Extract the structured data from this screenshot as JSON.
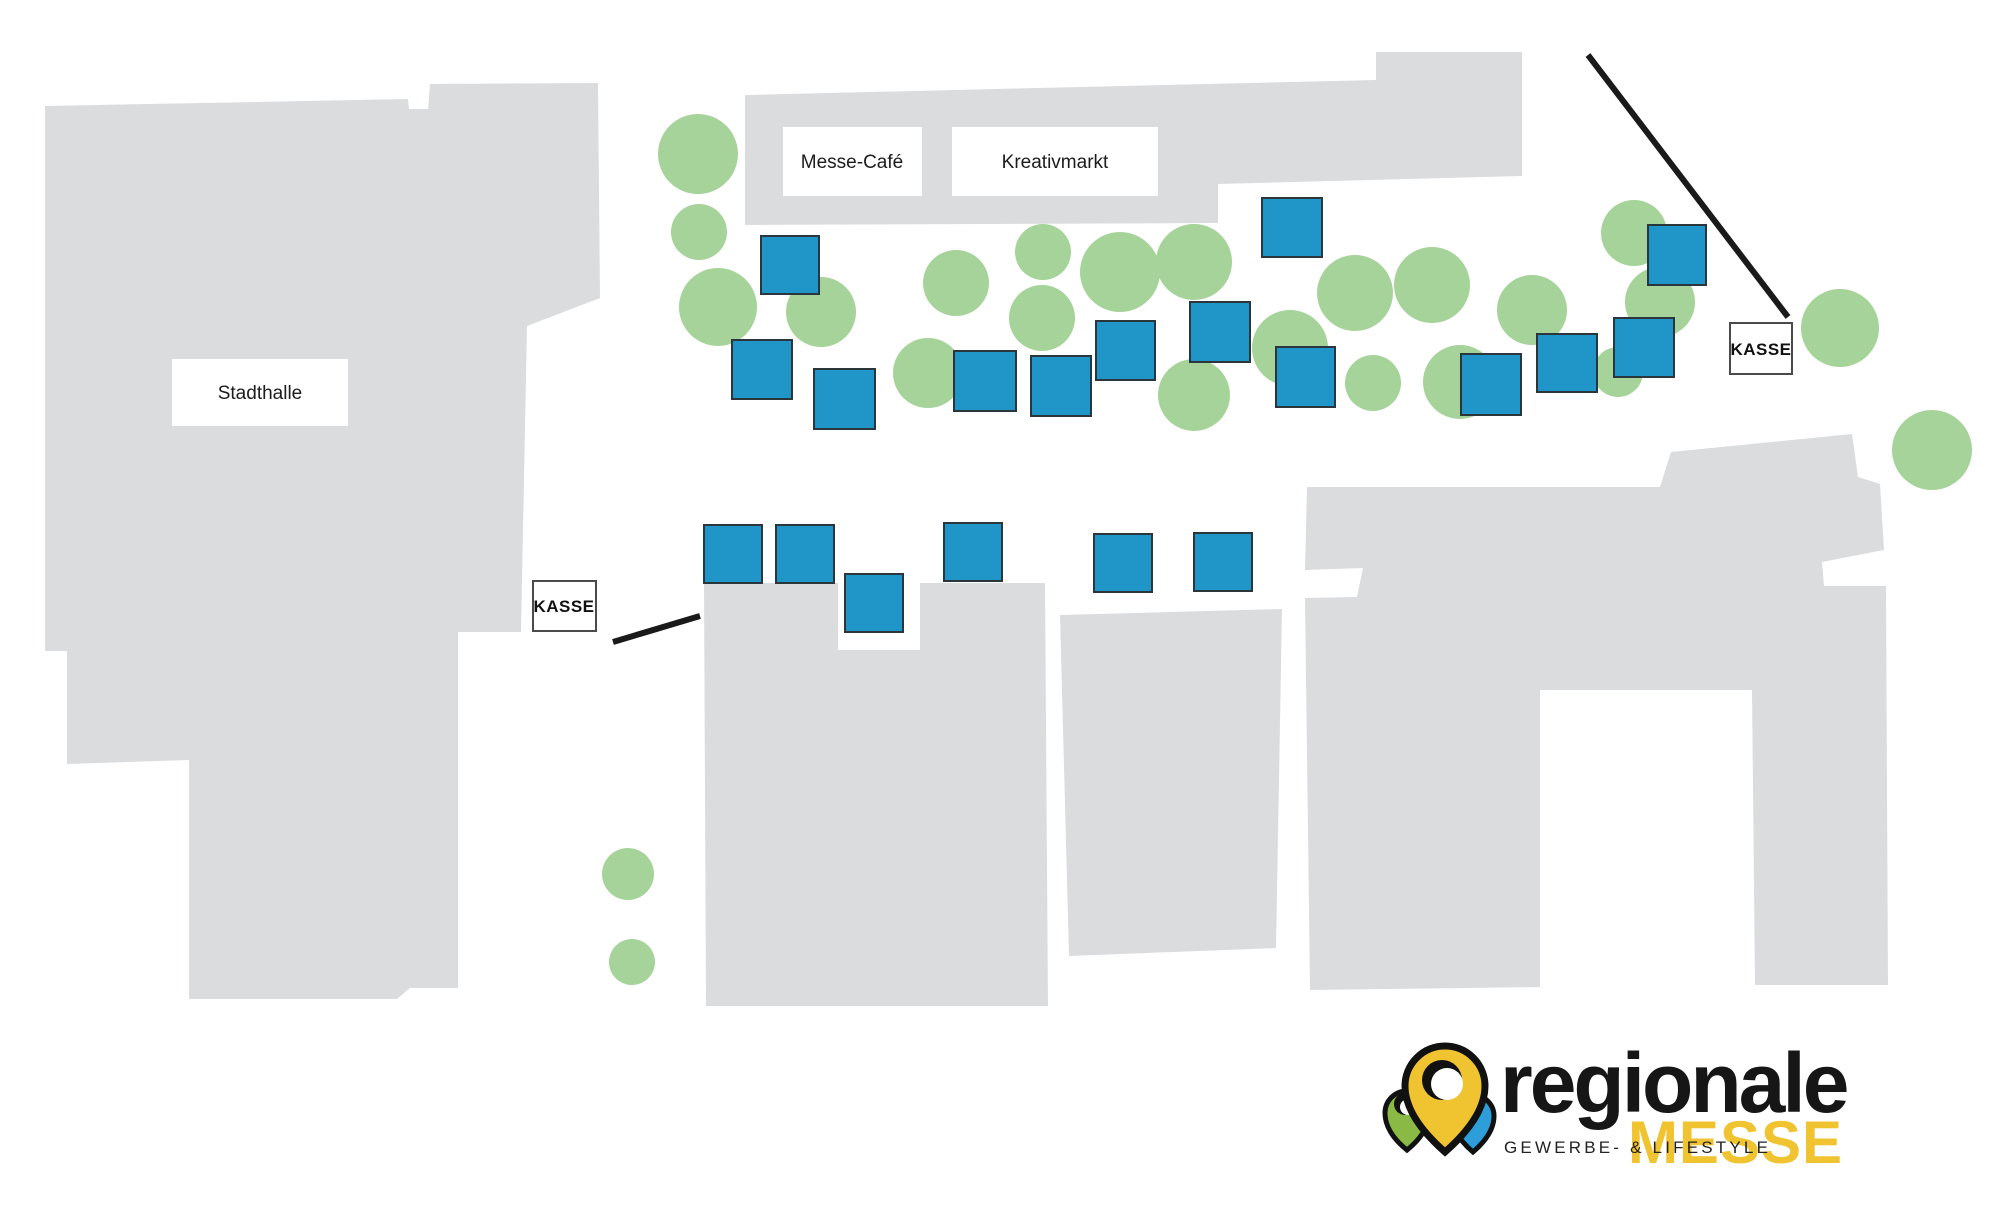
{
  "labels": {
    "stadthalle": {
      "text": "Stadthalle"
    },
    "messe_cafe": {
      "text": "Messe-Café"
    },
    "kreativmarkt": {
      "text": "Kreativmarkt"
    },
    "kasse_left": {
      "text": "KASSE"
    },
    "kasse_right": {
      "text": "KASSE"
    }
  },
  "logo": {
    "brand": "regionale",
    "brand_sub": "MESSE",
    "tagline": "GEWERBE- & LIFESTYLE"
  },
  "colors": {
    "booth": "#2095c8",
    "booth_border": "#2a353c",
    "tree": "#a6d399",
    "building": "#dbdcde",
    "line": "#1a1a1a",
    "logo_yellow": "#f0c330",
    "logo_green": "#8aba45",
    "logo_blue": "#2d9ed9"
  },
  "map": {
    "booths": [
      [
        761,
        236,
        58,
        58
      ],
      [
        732,
        340,
        60,
        59
      ],
      [
        814,
        369,
        61,
        60
      ],
      [
        954,
        351,
        62,
        60
      ],
      [
        1031,
        356,
        60,
        60
      ],
      [
        1096,
        321,
        59,
        59
      ],
      [
        1190,
        302,
        60,
        60
      ],
      [
        1262,
        198,
        60,
        59
      ],
      [
        1276,
        347,
        59,
        60
      ],
      [
        1461,
        354,
        60,
        61
      ],
      [
        1537,
        334,
        60,
        58
      ],
      [
        1614,
        318,
        60,
        59
      ],
      [
        1648,
        225,
        58,
        60
      ],
      [
        704,
        525,
        58,
        58
      ],
      [
        776,
        525,
        58,
        58
      ],
      [
        845,
        574,
        58,
        58
      ],
      [
        944,
        523,
        58,
        58
      ],
      [
        1094,
        534,
        58,
        58
      ],
      [
        1194,
        533,
        58,
        58
      ]
    ],
    "trees": [
      [
        698,
        154,
        40
      ],
      [
        699,
        232,
        28
      ],
      [
        718,
        307,
        39
      ],
      [
        821,
        312,
        35
      ],
      [
        956,
        283,
        33
      ],
      [
        1043,
        252,
        28
      ],
      [
        1042,
        318,
        33
      ],
      [
        928,
        373,
        35
      ],
      [
        1120,
        272,
        40
      ],
      [
        1194,
        262,
        38
      ],
      [
        1355,
        293,
        38
      ],
      [
        1432,
        285,
        38
      ],
      [
        1532,
        310,
        35
      ],
      [
        1194,
        395,
        36
      ],
      [
        1290,
        348,
        38
      ],
      [
        1373,
        383,
        28
      ],
      [
        1460,
        382,
        37
      ],
      [
        1634,
        233,
        33
      ],
      [
        1660,
        302,
        35
      ],
      [
        1618,
        372,
        25
      ],
      [
        1840,
        328,
        39
      ],
      [
        1932,
        450,
        40
      ],
      [
        628,
        874,
        26
      ],
      [
        632,
        962,
        23
      ]
    ],
    "entry_lines": [
      [
        1588,
        55,
        1788,
        317
      ],
      [
        613,
        642,
        700,
        616
      ]
    ]
  }
}
